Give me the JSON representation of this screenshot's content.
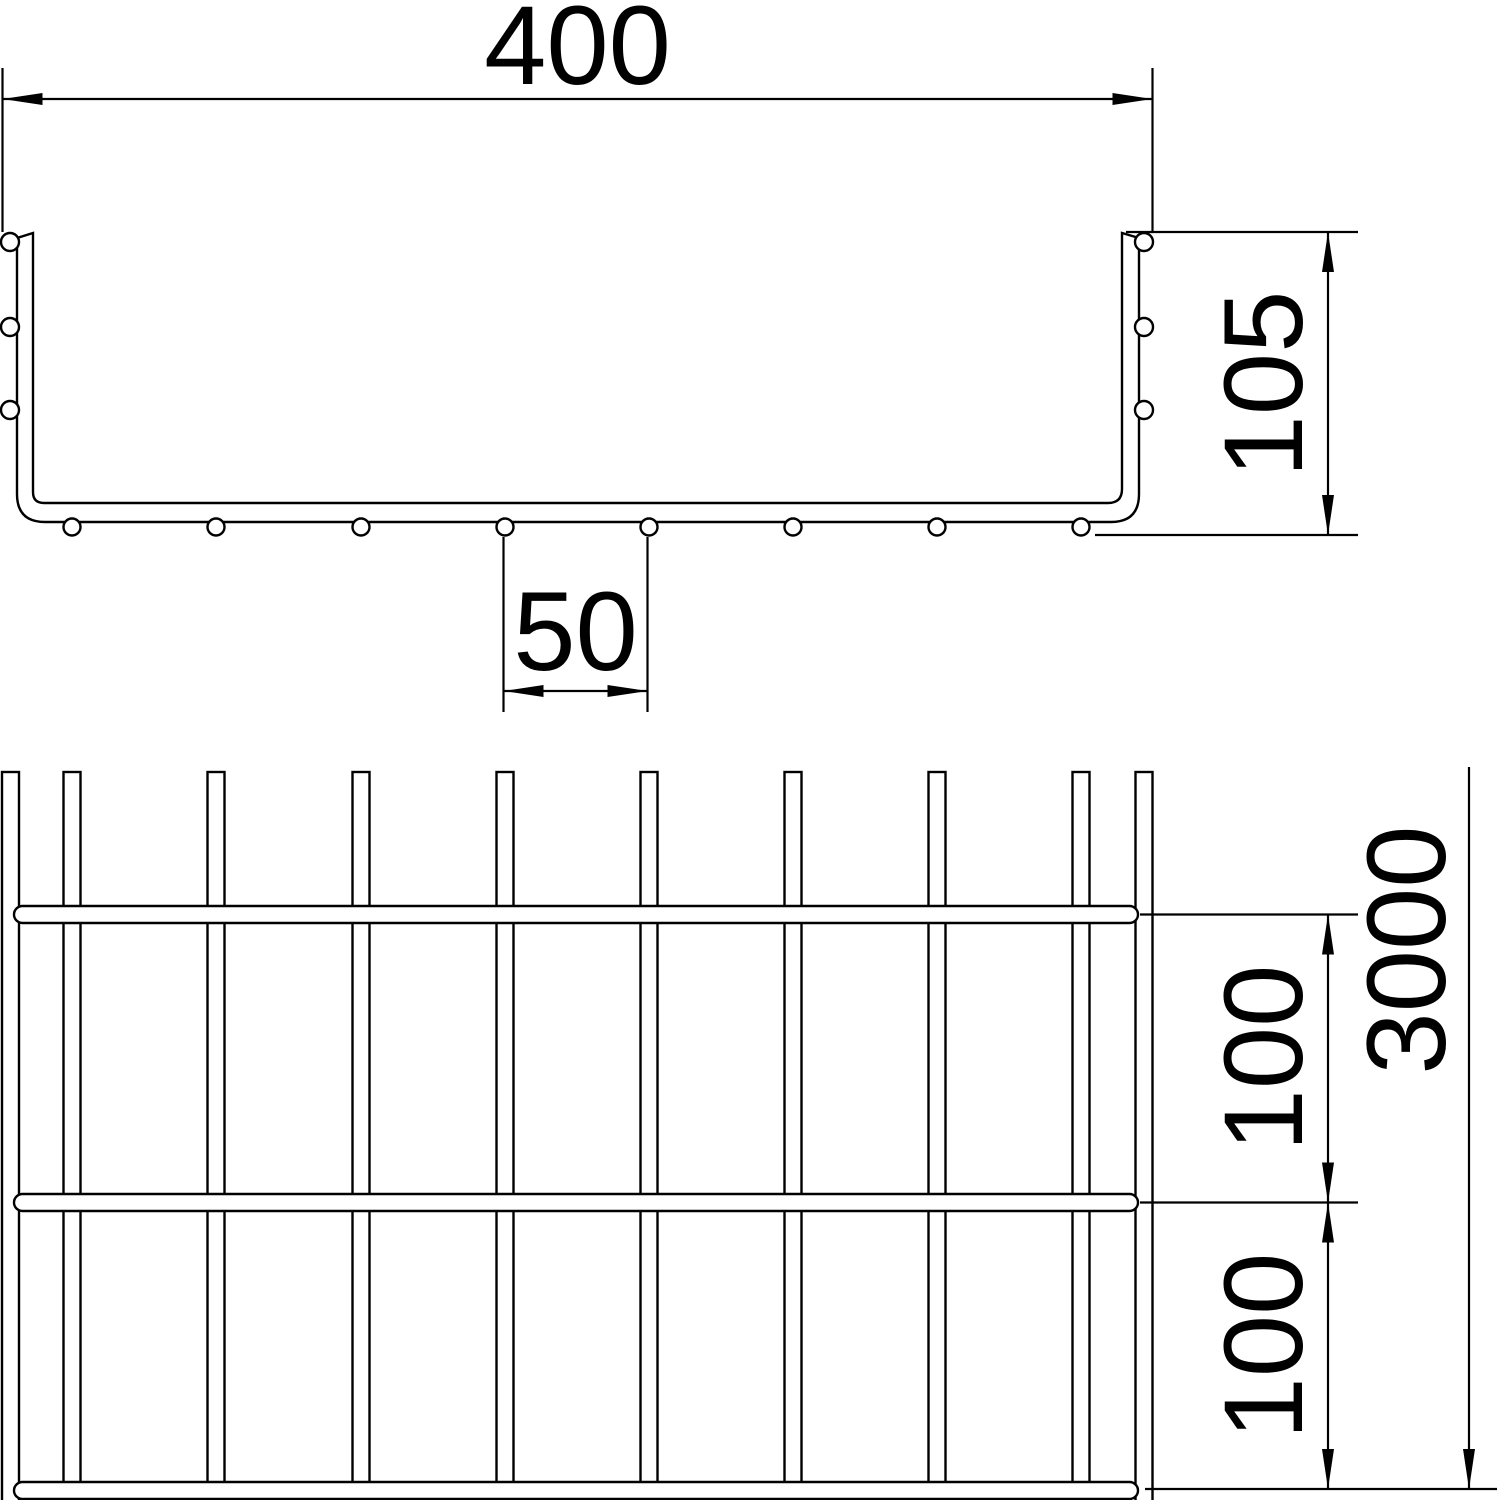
{
  "cross_section": {
    "width_label": "400",
    "height_label": "105",
    "wire_spacing_label": "50"
  },
  "plan_view": {
    "length_label": "3000",
    "rung_spacing_upper_label": "100",
    "rung_spacing_lower_label": "100"
  },
  "style": {
    "line_color": "#000000",
    "background_color": "#ffffff",
    "text_color": "#000000"
  }
}
